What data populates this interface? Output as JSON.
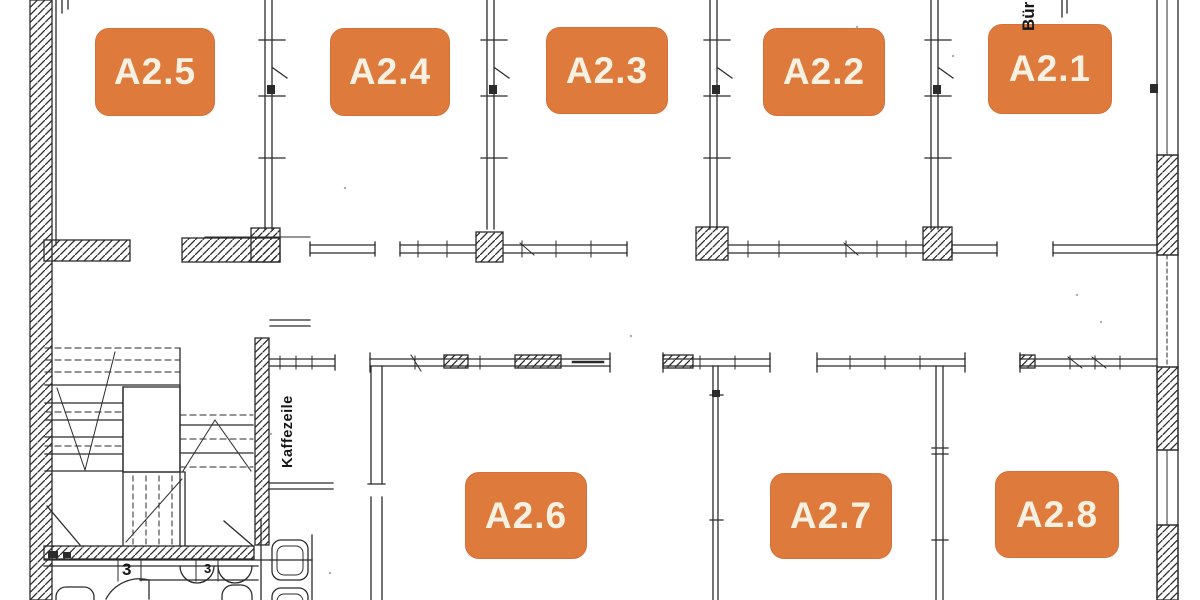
{
  "colors": {
    "background": "#FFFFFF",
    "line": "#2B2B2B",
    "room_badge_bg": "#DE7A3C",
    "room_badge_text": "#F8F1E2"
  },
  "floorplan": {
    "rooms": [
      {
        "label": "A2.5"
      },
      {
        "label": "A2.4"
      },
      {
        "label": "A2.3"
      },
      {
        "label": "A2.2"
      },
      {
        "label": "A2.1"
      },
      {
        "label": "A2.6"
      },
      {
        "label": "A2.7"
      },
      {
        "label": "A2.8"
      }
    ],
    "annotations": {
      "corridor_label": "Kaffezeile",
      "partial_room_label": "Bür",
      "door_numbers": [
        "3",
        "3"
      ]
    }
  }
}
